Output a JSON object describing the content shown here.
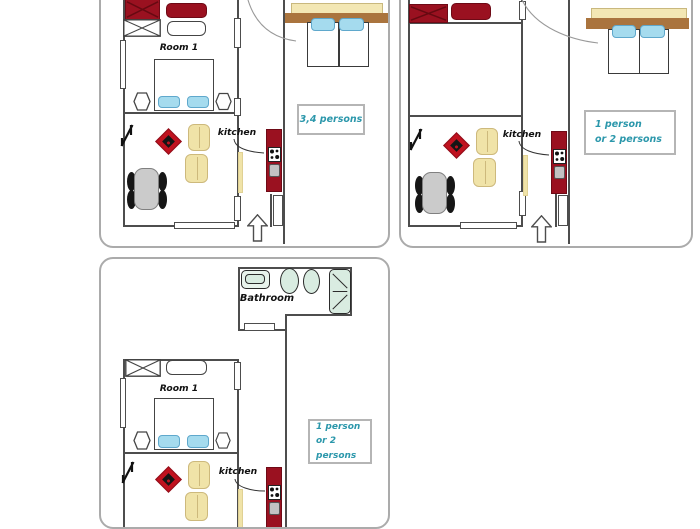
{
  "panels": {
    "a": {
      "room1_label": "Room 1",
      "kitchen_label": "kitchen",
      "capacity_line1": "3,4 persons"
    },
    "b": {
      "kitchen_label": "kitchen",
      "capacity_line1": "1 person",
      "capacity_line2": "or 2 persons"
    },
    "c": {
      "room1_label": "Room 1",
      "kitchen_label": "kitchen",
      "bathroom_label": "Bathroom",
      "capacity_line1": "1 person",
      "capacity_line2": "or 2 persons"
    }
  },
  "colors": {
    "furniture_red": "#9a1120",
    "rug_red": "#c0121f",
    "pillow_blue": "#a5dbee",
    "wood_brown": "#aa743e",
    "headboard_cream": "#f3e7b4",
    "chair_yellow": "#f0e3a8",
    "bathroom_mint": "#d9ece1",
    "table_gray": "#cbcbcb",
    "wall_gray": "#4d4d4d",
    "capacity_text_teal": "#2b97ab",
    "panel_border_gray": "#ababab"
  }
}
